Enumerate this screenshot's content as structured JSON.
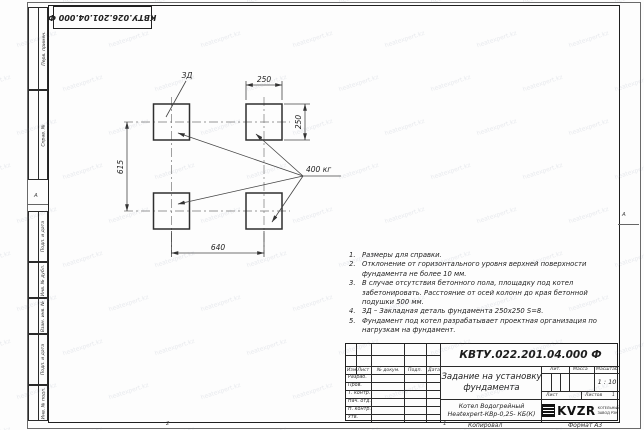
{
  "sheet": {
    "top_designation_mirrored": "КВТУ.026.201.04.000 Ф",
    "margin_graphs": [
      "Перв. примен.",
      "Справ. №",
      "Подп. и дата",
      "Инв. № дубл.",
      "Взам. инв. №",
      "Подп. и дата",
      "Инв. № подл."
    ],
    "zone_marks": {
      "left": "А",
      "right": "А",
      "bottom_1": "2",
      "bottom_2": "1"
    },
    "footer": {
      "copied_label": "Копировал",
      "format_label": "Формат А3"
    }
  },
  "drawing": {
    "labels": {
      "embed_detail": "ЗД",
      "load": "400 кг"
    },
    "dimensions": {
      "square_width": "250",
      "square_height": "250",
      "vertical_spacing": "615",
      "horizontal_spacing": "640"
    },
    "foundation_pads": 4
  },
  "notes": [
    "Размеры для справки.",
    "Отклонение от горизонтального уровня верхней поверхности фундамента не более 10 мм.",
    "В случае отсутствия бетонного пола, площадку под котел забетонировать. Расстояние от осей колонн до края бетонной подушки 500 мм.",
    "ЗД – Закладная деталь фундамента 250х250 S=8.",
    "Фундамент под котел разрабатывает проектная организация по нагрузкам на фундамент."
  ],
  "title_block": {
    "designation": "КВТУ.022.201.04.000 Ф",
    "doc_title": "Задание на установку фундамента",
    "columns": {
      "izm": "Изм.",
      "list": "Лист",
      "n_doc": "№ докум.",
      "podp": "Подп.",
      "data": "Дата"
    },
    "rows": [
      "Разраб.",
      "Пров.",
      "Т. контр.",
      "Нач. отд.",
      "Н. контр.",
      "Утв."
    ],
    "lit_label": "Лит.",
    "mass_label": "Масса",
    "scale_label": "Масштаб",
    "scale_value": "1 : 10",
    "sheet_label": "Лист",
    "sheets_label": "Листов",
    "sheets_value": "1",
    "product_line1": "Котел Водогрейный",
    "product_line2": "Heatexpert-КВр-0,25- КБ(К)",
    "company": {
      "logo": "KVZR",
      "tagline_line1": "КОТЕЛЬНЫЙ",
      "tagline_line2": "ЗАВОД РЗК"
    }
  },
  "watermark": {
    "text": "heatexpert.kz"
  },
  "colors": {
    "line": "#2f2f2f",
    "dim": "#444444",
    "paper": "#fdfdfd",
    "watermark": "#7a86a0"
  }
}
